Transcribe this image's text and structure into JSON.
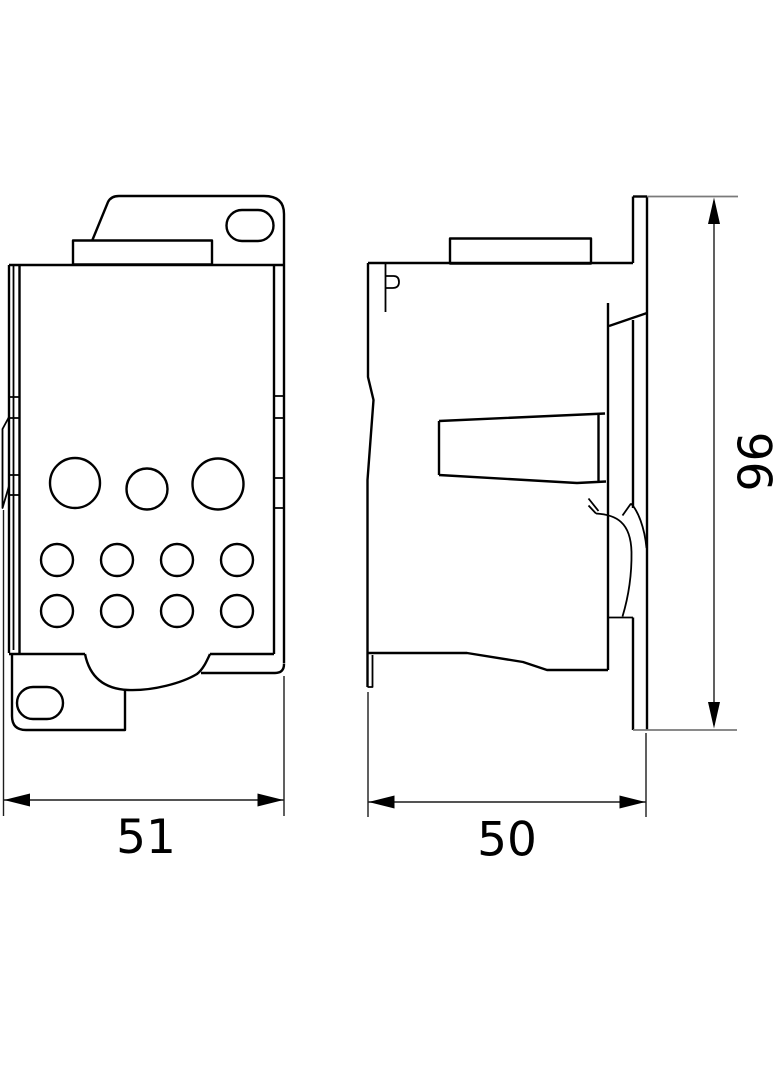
{
  "drawing": {
    "kind": "technical-dimension-drawing",
    "views": [
      {
        "id": "front-view",
        "hole_rows": [
          3,
          4,
          4
        ]
      },
      {
        "id": "side-view"
      }
    ]
  },
  "dimensions": {
    "front_width": "51",
    "side_width": "50",
    "height": "96"
  },
  "colors": {
    "line": "#000000",
    "dimension_line": "#1c1c1c",
    "extension_line_gray": "#7a7a7a",
    "background": "#ffffff"
  }
}
